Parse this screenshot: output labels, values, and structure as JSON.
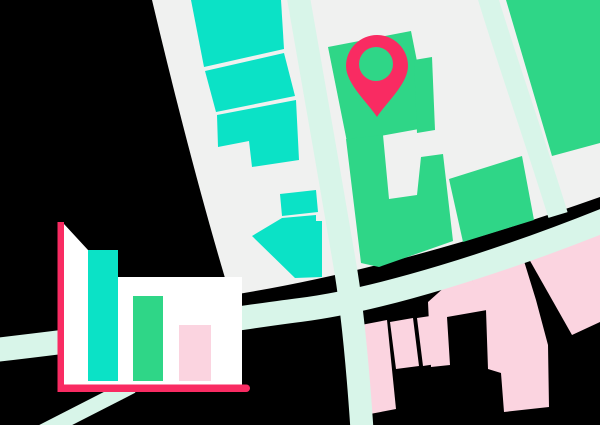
{
  "colors": {
    "background": "#000000",
    "map_surface": "#F0F1F0",
    "road": "#D8F5E9",
    "teal_building": "#0BE2C6",
    "green_building": "#2FD687",
    "pink_building": "#FBD4E0",
    "accent": "#F92B62",
    "panel": "#FFFFFF"
  },
  "map": {
    "pin": {
      "icon": "location-pin-icon",
      "color": "#F92B62",
      "hole_color": "#2FD687"
    }
  },
  "chart_data": {
    "type": "bar",
    "categories": [
      "bar-1",
      "bar-2",
      "bar-3"
    ],
    "values": [
      131,
      85,
      56
    ],
    "value_note": "relative bar heights measured in pixels; chart has no axis labels, ticks or legend",
    "title": "",
    "xlabel": "",
    "ylabel": "",
    "bar_colors": [
      "#0BE2C6",
      "#2FD687",
      "#FBD4E0"
    ],
    "axis_color": "#F92B62",
    "panel_color": "#FFFFFF",
    "legend": "none",
    "grid": "off"
  }
}
